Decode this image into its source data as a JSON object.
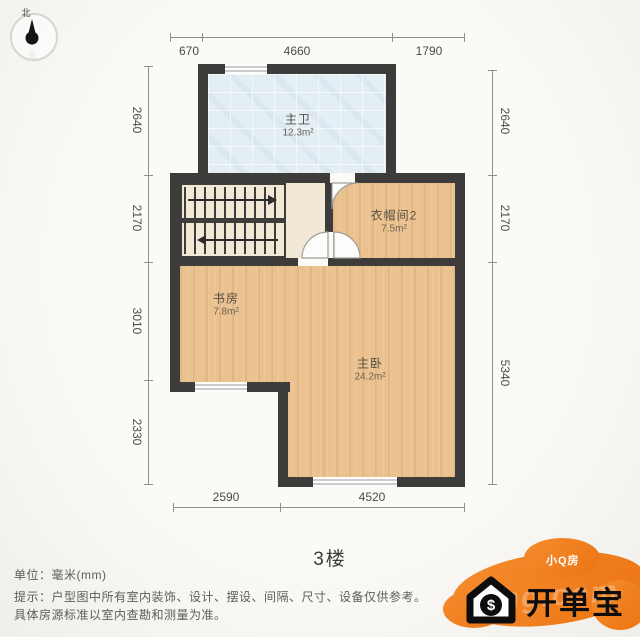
{
  "meta": {
    "floor_label": "3楼"
  },
  "compass": {
    "north_label": "北",
    "south_label": "南"
  },
  "rooms": [
    {
      "id": "bathroom",
      "name": "主卫",
      "area": "12.3m²"
    },
    {
      "id": "cloakroom",
      "name": "衣帽间2",
      "area": "7.5m²"
    },
    {
      "id": "study",
      "name": "书房",
      "area": "7.8m²"
    },
    {
      "id": "bedroom",
      "name": "主卧",
      "area": "24.2m²"
    }
  ],
  "dimensions": {
    "top": [
      "670",
      "4660",
      "1790"
    ],
    "left": [
      "2640",
      "2170",
      "3010",
      "2330"
    ],
    "right": [
      "2640",
      "2170",
      "5340"
    ],
    "bottom": [
      "2590",
      "4520"
    ]
  },
  "footer": {
    "unit_line": "单位：毫米(mm)",
    "note_line1": "提示：户型图中所有室内装饰、设计、摆设、间隔、尺寸、设备仅供参考。",
    "note_line2": "具体房源标准以室内查勘和测量为准。"
  },
  "watermark": {
    "brand": "开单宝",
    "sub_brand": "小Q房",
    "dollar": "$",
    "faint_text": "fang.com",
    "orange": "#ee7b1c"
  },
  "colors": {
    "wall": "#3d3c3a",
    "wood_floor": "#ebc28f",
    "bath_floor": "#e4eef5",
    "stair_floor": "#f1e9d6",
    "background": "#f7f6f3"
  }
}
